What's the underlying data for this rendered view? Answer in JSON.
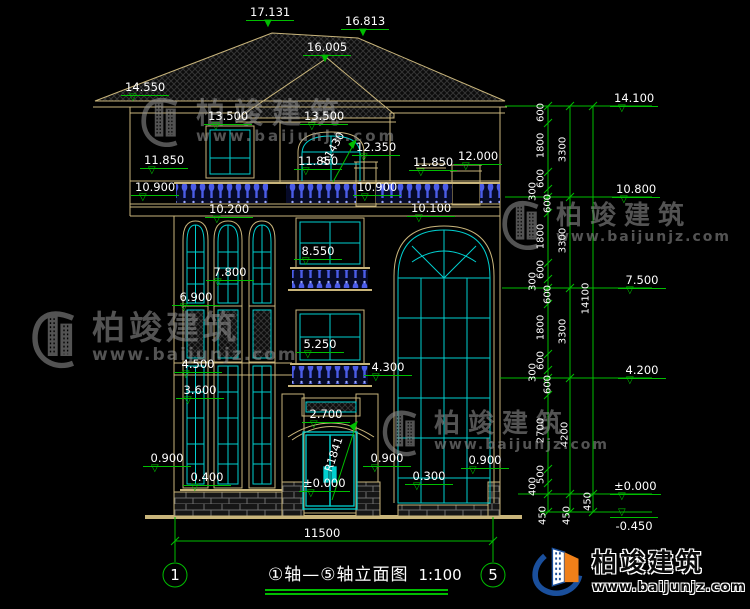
{
  "watermark": {
    "brand": "柏竣建筑",
    "url": "www.baijunjz.com"
  },
  "logo": {
    "brand": "柏竣建筑",
    "url": "www.baijunjz.com"
  },
  "title_block": {
    "name": "①轴—⑤轴立面图",
    "scale": "1:100"
  },
  "axes": {
    "left": "1",
    "right": "5"
  },
  "span_dim": "11500",
  "icons": {
    "elev_open": "▽",
    "elev_solid": "▼"
  },
  "elevations": [
    "17.131",
    "16.813",
    "16.005",
    "14.550",
    "13.500",
    "13.500",
    "12.350",
    "11.850",
    "11.850",
    "11.850",
    "12.000",
    "10.900",
    "10.900",
    "10.200",
    "10.100",
    "8.550",
    "7.800",
    "6.900",
    "5.250",
    "4.500",
    "4.300",
    "3.600",
    "2.700",
    "0.900",
    "0.400",
    "0.900",
    "0.900",
    "0.300",
    "±0.000",
    "14.100",
    "10.800",
    "7.500",
    "4.200",
    "±0.000",
    "-0.450"
  ],
  "chain_dims": [
    "600",
    "1800",
    "600",
    "300",
    "600",
    "1800",
    "600",
    "300",
    "600",
    "1800",
    "600",
    "300",
    "600",
    "2700",
    "500",
    "400",
    "450",
    "3300",
    "3300",
    "3300",
    "4200",
    "450",
    "14100",
    "450"
  ],
  "radii": [
    "R1430",
    "R1841"
  ],
  "colors": {
    "dimension": "#00BE00",
    "outline": "#C9B57B",
    "glazing": "#00CFCF",
    "baluster": "#3B4FD8",
    "logo_blue": "#1A4F9C",
    "logo_orange": "#F08019"
  }
}
